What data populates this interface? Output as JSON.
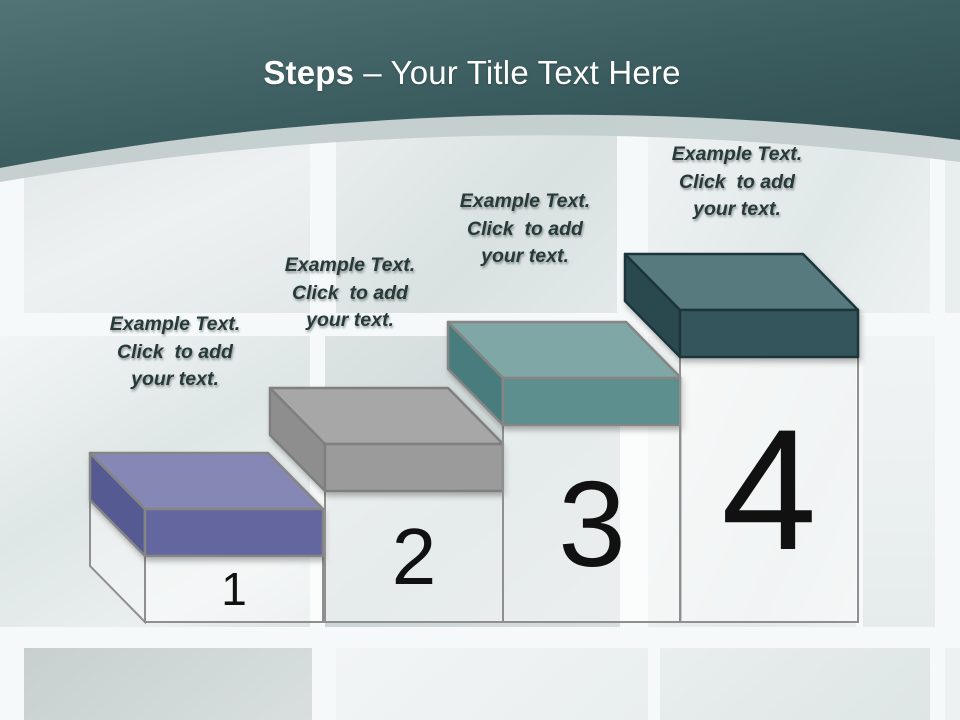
{
  "header": {
    "title_bold": "Steps",
    "title_rest": "– Your Title Text Here",
    "colors": {
      "teal_light": "#527476",
      "teal_mid": "#3d5f61",
      "teal_dark": "#2e4d50",
      "band": "#c3cdcd",
      "title_text": "#ffffff"
    }
  },
  "steps": [
    {
      "number": "1",
      "label": "Example Text.\nClick  to add\nyour text.",
      "colors": {
        "top": "#8588b5",
        "front": "#63669f",
        "side": "#575a93",
        "outline": "#858585"
      }
    },
    {
      "number": "2",
      "label": "Example Text.\nClick  to add\nyour text.",
      "colors": {
        "top": "#a7a7a7",
        "front": "#9b9b9b",
        "side": "#8e8e8e",
        "outline": "#7f7f7f"
      }
    },
    {
      "number": "3",
      "label": "Example Text.\nClick  to add\nyour text.",
      "colors": {
        "top": "#7fa7a6",
        "front": "#5d8f8e",
        "side": "#497c7b",
        "outline": "#858585"
      }
    },
    {
      "number": "4",
      "label": "Example Text.\nClick  to add\nyour text.",
      "colors": {
        "top": "#567a7e",
        "front": "#35555c",
        "side": "#2c4950",
        "outline": "#1e343a"
      }
    }
  ],
  "text_style": {
    "label_color": "#27393a",
    "number_color": "#111111"
  }
}
